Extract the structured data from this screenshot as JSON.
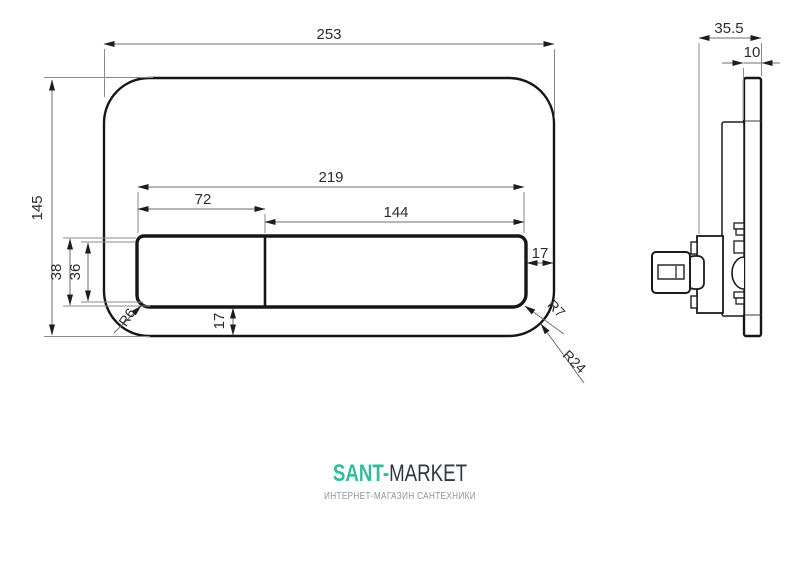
{
  "drawing": {
    "title": "flush-plate technical drawing, front and side views",
    "front_view": {
      "labels": {
        "overall_width": "253",
        "overall_height": "145",
        "buttons_total_width": "219",
        "small_button_width": "72",
        "large_button_width": "144",
        "button_height_outer": "38",
        "button_height_inner": "36",
        "right_gap": "17",
        "bottom_gap": "17",
        "radius_small_button": "R6",
        "radius_large_button": "R7",
        "radius_plate_corner": "R24"
      }
    },
    "side_view": {
      "labels": {
        "overall_depth": "35.5",
        "plate_thickness": "10"
      }
    },
    "line_color": "#161616"
  },
  "footer": {
    "logo_accent": "SANT-",
    "logo_rest": "MARKET",
    "tagline": "ИНТЕРНЕТ-МАГАЗИН САНТЕХНИКИ",
    "colors": {
      "accent": "#2fbd9a",
      "logo_dark": "#33373d",
      "tagline_gray": "#8e949c"
    }
  }
}
